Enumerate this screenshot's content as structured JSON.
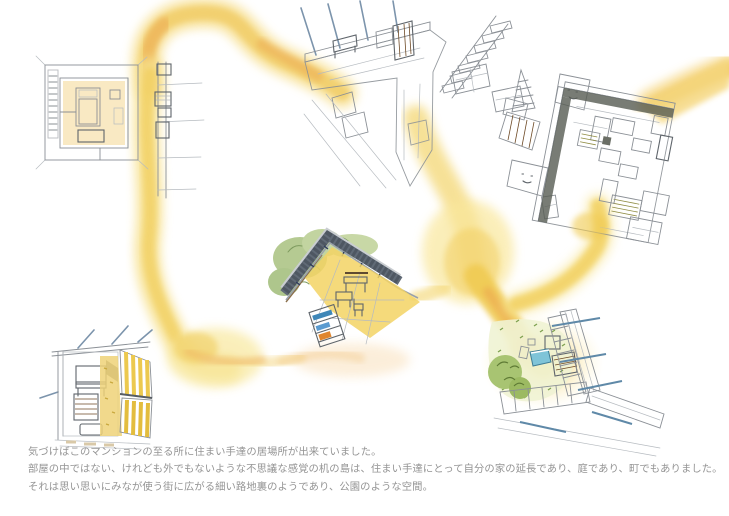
{
  "page": {
    "background": "#ffffff",
    "kind": "hand-drawn architectural concept illustration"
  },
  "caption": {
    "lines": [
      "気づけばこのマンションの至る所に住まい手達の居場所が出来ていました。",
      "部屋の中ではない、けれども外でもないような不思議な感覚の机の島は、住まい手達にとって自分の家の延長であり、庭であり、町でもありました。",
      "それは思い思いにみなが使う街に広がる細い路地裏のようであり、公園のような空間。"
    ],
    "text_color": "#949494"
  },
  "palette": {
    "path_yellow_light": "#f8e79c",
    "path_yellow": "#f0cb52",
    "path_orange": "#eca64c",
    "floor_yellow": "#f0cf52",
    "pencil_gray": "#8b9096",
    "foliage_green": "#b5ca92",
    "bush_green": "#a8c472",
    "furniture_green": "#9fc577",
    "furniture_pink": "#f2b6c2",
    "furniture_blue": "#aed3e4",
    "wood_brown": "#8a6b42",
    "railing_dark": "#4e5762",
    "beam_blue": "#5f89a8"
  },
  "scenes": [
    {
      "id": "room-plan-top-left",
      "desc": "plan of a dwelling room with bed, dresser and shelf wall"
    },
    {
      "id": "corridor-top-center",
      "desc": "axonometric corridor corner with bench, shelf, tub and stairs"
    },
    {
      "id": "room-top-right",
      "desc": "tilted plan of a room filled with desks and colored furniture"
    },
    {
      "id": "balcony-center",
      "desc": "corner balcony with planting, benches, table and bookshelf"
    },
    {
      "id": "room-bottom-left",
      "desc": "interior corner with table, louver shelf and striped screens"
    },
    {
      "id": "garden-bottom-right",
      "desc": "courtyard garden corner with paving, bushes and tables"
    },
    {
      "id": "alley-path-network",
      "desc": "yellow watercolor alley paths linking every scene"
    }
  ]
}
